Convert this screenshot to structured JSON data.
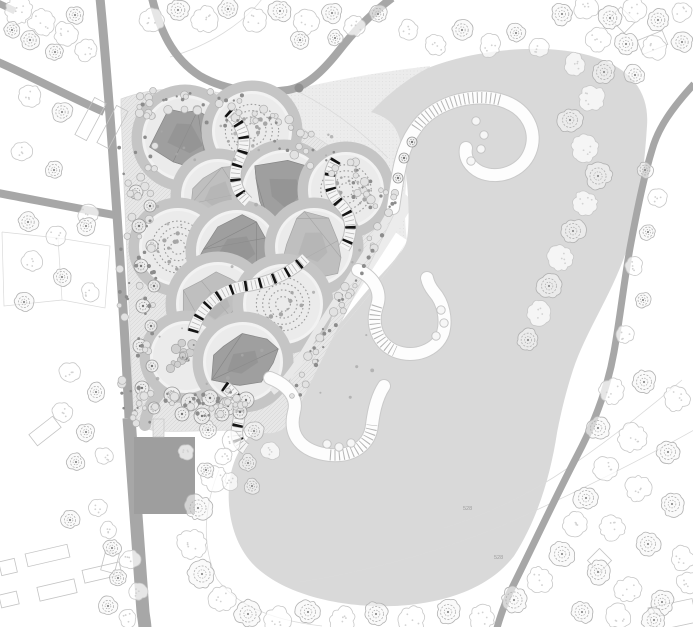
{
  "canvas": {
    "width": 693,
    "height": 627
  },
  "palette": {
    "background": "#ffffff",
    "lake": "#d9d9d9",
    "meadow": "#ececec",
    "meadow_dot": "#dcdcdc",
    "garden_base": "#e7e7e7",
    "garden_hatch": "#d2d2d2",
    "path_band": "#c5c5c5",
    "room_disc": "#ebebeb",
    "room_white_ring": "#f2f2f2",
    "canopy_dark": "#9b9b9b",
    "canopy_dark_line": "#868686",
    "canopy_light": "#bdbdbd",
    "canopy_light_line": "#a5a5a5",
    "ring_planting": "#9a9a9a",
    "shrub": "#a6a6a6",
    "road": "#a7a7a7",
    "building_solid": "#9e9e9e",
    "pier_fill": "#fdfdfd",
    "pier_edge": "#c9c9c9",
    "pier_tick": "#b5b5b5",
    "stair_tread": "#141414",
    "stair_fill": "#f5f5f5",
    "stair_edge": "#bdbdbd",
    "tree_fluffy_stroke": "#c8c8c8",
    "tree_rosette_stroke": "#b2b2b2",
    "tree_small_stroke": "#979797",
    "contour": "#dadada",
    "label_color": "#9e9e9e",
    "junction": "#8f8f8f"
  },
  "labels": [
    {
      "text": "528",
      "x": 463,
      "y": 510
    },
    {
      "text": "528",
      "x": 494,
      "y": 559
    }
  ],
  "map": {
    "lake": {
      "path": "M 428,68 C 468,52 528,44 574,52 C 624,61 650,86 647,126 C 644,172 639,212 626,252 C 611,296 586,331 573,370 C 564,398 560,418 557,433 C 551,472 539,517 514,556 C 487,591 439,604 394,606 C 344,608 288,596 257,568 C 234,547 227,514 229,487 C 231,461 242,441 259,427 C 272,416 281,403 289,392 C 311,362 341,330 369,295 C 391,267 402,252 407,239 C 403,250 392,264 378,278 L 378,278 C 402,252 405,248 407,239 C 411,215 407,165 400,140 C 396,126 390,118 371,112 C 386,96 405,80 428,68 Z"
    },
    "lake_west_fix": {
      "path": "M 407,239 C 403,250 392,264 378,278 C 350,310 320,348 289,392 C 311,362 341,330 369,295 C 391,267 402,252 407,239 Z"
    },
    "meadow": {
      "path": "M 260,98 C 320,82 378,72 430,66 C 428,96 416,130 408,170 C 404,195 404,220 407,240 C 390,230 370,210 350,185 C 325,155 295,125 260,98 Z",
      "strip": "M 398,205 C 370,250 340,295 312,340 C 298,364 288,384 280,400"
    },
    "garden": {
      "zone": "M 121,99 C 158,85 200,86 240,98 C 282,112 330,146 390,186 C 398,192 400,202 395,212 C 362,282 325,352 297,412 C 290,428 278,436 262,433 C 230,427 192,433 158,431 C 143,430 134,422 133,407 C 129,306 125,200 121,112 Z",
      "rooms": [
        {
          "cx": 185,
          "cy": 138,
          "r": 40,
          "type": "canopy"
        },
        {
          "cx": 252,
          "cy": 131,
          "r": 37,
          "type": "rings"
        },
        {
          "cx": 218,
          "cy": 196,
          "r": 34,
          "type": "facet"
        },
        {
          "cx": 284,
          "cy": 192,
          "r": 39,
          "type": "canopy"
        },
        {
          "cx": 346,
          "cy": 190,
          "r": 35,
          "type": "rings"
        },
        {
          "cx": 178,
          "cy": 247,
          "r": 36,
          "type": "rings"
        },
        {
          "cx": 237,
          "cy": 251,
          "r": 38,
          "type": "canopy"
        },
        {
          "cx": 314,
          "cy": 247,
          "r": 36,
          "type": "facet"
        },
        {
          "cx": 218,
          "cy": 304,
          "r": 39,
          "type": "facet"
        },
        {
          "cx": 283,
          "cy": 304,
          "r": 37,
          "type": "rings"
        },
        {
          "cx": 186,
          "cy": 357,
          "r": 33,
          "type": "shrubs"
        },
        {
          "cx": 243,
          "cy": 362,
          "r": 37,
          "type": "canopy"
        }
      ],
      "connector": "M 158,395 C 150,405 146,415 145,425",
      "stairs": [
        "M 228,112 C 244,126 248,142 240,158 C 232,174 234,190 248,202",
        "M 336,160 C 326,176 328,192 340,204 C 352,216 354,232 344,248",
        "M 193,332 C 200,306 220,290 246,286 C 272,282 292,272 306,258",
        "M 224,386 C 236,394 242,406 238,424 C 235,436 238,444 246,449"
      ],
      "scatter": [
        {
          "x": 119,
          "y": 108,
          "w": 38,
          "h": 318,
          "shear": 0,
          "count": 70,
          "seed": 7
        },
        {
          "x": 138,
          "y": 86,
          "w": 120,
          "h": 36,
          "shear": 0.08,
          "count": 40,
          "seed": 11
        },
        {
          "x": 255,
          "y": 96,
          "w": 140,
          "h": 40,
          "shear": 0.62,
          "count": 48,
          "seed": 13
        },
        {
          "x": 286,
          "y": 398,
          "w": 112,
          "h": 26,
          "shear": -1.95,
          "count": 44,
          "seed": 17
        },
        {
          "x": 165,
          "y": 390,
          "w": 85,
          "h": 26,
          "shear": 0,
          "count": 34,
          "seed": 19
        },
        {
          "x": 152,
          "y": 112,
          "w": 225,
          "h": 286,
          "shear": 0,
          "count": 36,
          "seed": 23,
          "tiny": true
        }
      ]
    },
    "roads": [
      {
        "path": "M 100,-2 C 106,60 112,140 117,215 C 122,290 126,350 129,418",
        "width": 9
      },
      {
        "path": "M 129,418 C 133,470 138,540 143,612 C 144,620 145,624 145,629",
        "width": 13
      },
      {
        "path": "M -2,62 C 30,76 68,96 104,112",
        "width": 8
      },
      {
        "path": "M -2,193 C 35,200 75,208 114,215",
        "width": 8
      },
      {
        "path": "M 152,-2 C 160,30 172,58 200,76 C 228,92 262,94 288,90 C 306,87 322,72 338,52 C 352,34 368,16 392,-2",
        "width": 8
      },
      {
        "path": "M 694,84 C 672,108 658,128 652,150 C 644,176 637,210 630,248 C 624,282 620,318 614,352 C 608,386 596,420 577,456 C 556,496 532,548 509,594 C 504,606 500,617 497,628",
        "width": 7
      },
      {
        "path": "M -2,3 L 15,11",
        "width": 7
      }
    ],
    "junction": {
      "x": 299,
      "y": 88,
      "r": 4.5
    },
    "piers": [
      {
        "path": "M 393,208 C 398,175 400,150 416,128 C 432,104 470,92 500,100 C 528,108 538,132 530,152 C 522,172 498,180 480,172 C 470,167 464,158 466,148",
        "ticks": "M 416,128 C 432,104 470,92 500,100",
        "circles": [
          [
            476,
            121
          ],
          [
            484,
            135
          ],
          [
            481,
            149
          ],
          [
            471,
            161
          ]
        ]
      },
      {
        "path": "M 358,270 C 374,277 382,292 377,306 C 371,324 377,343 395,351 C 415,359 437,350 443,333 C 447,319 443,302 434,292 C 430,287 428,283 427,278",
        "ticks": "M 377,306 C 371,324 377,343 395,351",
        "circles": [
          [
            441,
            310
          ],
          [
            444,
            323
          ],
          [
            436,
            336
          ]
        ]
      },
      {
        "path": "M 270,378 C 288,385 298,398 294,412 C 288,436 302,452 330,455 C 354,457 370,444 372,425 C 374,408 378,395 384,386",
        "ticks": "M 330,455 C 354,457 370,444 372,425",
        "circles": [
          [
            327,
            444
          ],
          [
            339,
            447
          ],
          [
            351,
            443
          ]
        ]
      }
    ],
    "shore_path": "M 396,203 C 370,248 342,292 314,336 C 300,360 288,380 272,392",
    "buildings": {
      "solid": [
        {
          "x": 134,
          "y": 437,
          "w": 61,
          "h": 77
        }
      ],
      "hatch_pad": {
        "x": 153,
        "y": 419,
        "w": 11,
        "h": 18
      },
      "outline": [
        {
          "x": 84,
          "y": 98,
          "w": 13,
          "h": 42,
          "a": 28
        },
        {
          "x": 106,
          "y": 106,
          "w": 13,
          "h": 42,
          "a": 28
        },
        {
          "x": 30,
          "y": 424,
          "w": 30,
          "h": 14,
          "a": -38
        },
        {
          "x": 26,
          "y": 549,
          "w": 43,
          "h": 13,
          "a": -13
        },
        {
          "x": 83,
          "y": 566,
          "w": 38,
          "h": 13,
          "a": -13
        },
        {
          "x": 38,
          "y": 583,
          "w": 38,
          "h": 14,
          "a": -13
        },
        {
          "x": 0,
          "y": 560,
          "w": 16,
          "h": 14,
          "a": -13
        },
        {
          "x": 0,
          "y": 593,
          "w": 18,
          "h": 13,
          "a": -13
        },
        {
          "x": 100,
          "y": 555,
          "w": 20,
          "h": 14,
          "a": -75
        },
        {
          "x": 612,
          "y": 12,
          "w": 21,
          "h": 16,
          "a": 45
        },
        {
          "x": 639,
          "y": 35,
          "w": 27,
          "h": 15,
          "a": -22
        },
        {
          "x": 591,
          "y": 552,
          "w": 17,
          "h": 17,
          "a": 45
        },
        {
          "x": 650,
          "y": 603,
          "w": 45,
          "h": 24,
          "a": -12
        }
      ],
      "plots": [
        [
          [
            2,
            232
          ],
          [
            58,
            238
          ],
          [
            62,
            300
          ],
          [
            4,
            306
          ],
          [
            2,
            232
          ]
        ],
        [
          [
            58,
            238
          ],
          [
            110,
            246
          ],
          [
            105,
            308
          ],
          [
            62,
            300
          ]
        ]
      ]
    },
    "contours": [
      "M 694,430 C 630,466 566,497 506,524 C 446,549 376,570 300,582",
      "M 444,528 C 488,514 530,494 568,468 C 606,442 645,412 682,380",
      "M 262,-1 C 243,24 208,46 170,57",
      "M 219,470 C 204,506 201,546 217,579 C 238,607 276,621 322,626",
      "M 299,92 C 330,108 360,130 388,158"
    ],
    "trees": [
      [
        18,
        10,
        14,
        0
      ],
      [
        42,
        22,
        13,
        0
      ],
      [
        66,
        34,
        12,
        0
      ],
      [
        86,
        50,
        11,
        0
      ],
      [
        30,
        40,
        10,
        1
      ],
      [
        55,
        52,
        9,
        1
      ],
      [
        12,
        30,
        8,
        1
      ],
      [
        75,
        15,
        9,
        1
      ],
      [
        152,
        20,
        12,
        0
      ],
      [
        178,
        10,
        11,
        1
      ],
      [
        204,
        20,
        13,
        0
      ],
      [
        228,
        9,
        10,
        1
      ],
      [
        254,
        20,
        12,
        0
      ],
      [
        280,
        11,
        11,
        1
      ],
      [
        306,
        22,
        12,
        0
      ],
      [
        332,
        13,
        10,
        1
      ],
      [
        355,
        26,
        11,
        0
      ],
      [
        378,
        14,
        9,
        1
      ],
      [
        300,
        40,
        9,
        1
      ],
      [
        335,
        38,
        8,
        1
      ],
      [
        408,
        30,
        10,
        0
      ],
      [
        436,
        45,
        11,
        0
      ],
      [
        462,
        30,
        10,
        1
      ],
      [
        490,
        46,
        11,
        0
      ],
      [
        516,
        33,
        9,
        1
      ],
      [
        540,
        48,
        10,
        0
      ],
      [
        562,
        14,
        11,
        1
      ],
      [
        586,
        8,
        12,
        0
      ],
      [
        610,
        18,
        11,
        1
      ],
      [
        634,
        9,
        12,
        0
      ],
      [
        658,
        20,
        11,
        1
      ],
      [
        682,
        12,
        10,
        0
      ],
      [
        598,
        40,
        12,
        0
      ],
      [
        626,
        44,
        11,
        1
      ],
      [
        654,
        48,
        12,
        0
      ],
      [
        682,
        42,
        10,
        1
      ],
      [
        575,
        65,
        11,
        0
      ],
      [
        604,
        72,
        12,
        1
      ],
      [
        592,
        98,
        13,
        0
      ],
      [
        570,
        120,
        12,
        1
      ],
      [
        635,
        75,
        10,
        1
      ],
      [
        585,
        148,
        13,
        0
      ],
      [
        598,
        176,
        13,
        1
      ],
      [
        586,
        204,
        13,
        0
      ],
      [
        573,
        231,
        12,
        1
      ],
      [
        561,
        258,
        13,
        0
      ],
      [
        549,
        286,
        12,
        1
      ],
      [
        538,
        313,
        12,
        0
      ],
      [
        528,
        340,
        11,
        1
      ],
      [
        645,
        170,
        8,
        1
      ],
      [
        658,
        198,
        9,
        0
      ],
      [
        648,
        232,
        8,
        1
      ],
      [
        634,
        266,
        9,
        0
      ],
      [
        643,
        300,
        8,
        1
      ],
      [
        625,
        335,
        9,
        0
      ],
      [
        612,
        392,
        13,
        0
      ],
      [
        644,
        382,
        12,
        1
      ],
      [
        676,
        398,
        13,
        0
      ],
      [
        598,
        428,
        12,
        1
      ],
      [
        632,
        438,
        14,
        0
      ],
      [
        668,
        452,
        12,
        1
      ],
      [
        606,
        468,
        12,
        0
      ],
      [
        586,
        498,
        12,
        1
      ],
      [
        638,
        488,
        13,
        0
      ],
      [
        672,
        504,
        12,
        1
      ],
      [
        612,
        528,
        13,
        0
      ],
      [
        648,
        544,
        12,
        1
      ],
      [
        682,
        558,
        12,
        0
      ],
      [
        598,
        572,
        12,
        1
      ],
      [
        628,
        590,
        13,
        0
      ],
      [
        662,
        602,
        12,
        1
      ],
      [
        688,
        582,
        11,
        0
      ],
      [
        582,
        612,
        11,
        1
      ],
      [
        618,
        616,
        12,
        0
      ],
      [
        654,
        620,
        11,
        1
      ],
      [
        214,
        478,
        13,
        0
      ],
      [
        198,
        508,
        13,
        1
      ],
      [
        192,
        544,
        14,
        0
      ],
      [
        202,
        574,
        13,
        1
      ],
      [
        222,
        598,
        13,
        0
      ],
      [
        248,
        614,
        13,
        1
      ],
      [
        278,
        620,
        13,
        0
      ],
      [
        308,
        612,
        12,
        1
      ],
      [
        342,
        620,
        13,
        0
      ],
      [
        376,
        614,
        12,
        1
      ],
      [
        412,
        620,
        13,
        0
      ],
      [
        448,
        612,
        12,
        1
      ],
      [
        482,
        618,
        13,
        0
      ],
      [
        514,
        600,
        13,
        1
      ],
      [
        540,
        580,
        13,
        0
      ],
      [
        562,
        554,
        12,
        1
      ],
      [
        576,
        524,
        12,
        0
      ],
      [
        208,
        430,
        9,
        1
      ],
      [
        232,
        441,
        10,
        0
      ],
      [
        254,
        431,
        9,
        1
      ],
      [
        224,
        456,
        9,
        0
      ],
      [
        248,
        463,
        9,
        1
      ],
      [
        270,
        451,
        9,
        0
      ],
      [
        206,
        470,
        8,
        1
      ],
      [
        230,
        481,
        9,
        0
      ],
      [
        252,
        486,
        8,
        1
      ],
      [
        186,
        452,
        8,
        0
      ],
      [
        30,
        96,
        11,
        0
      ],
      [
        62,
        112,
        10,
        1
      ],
      [
        22,
        152,
        10,
        0
      ],
      [
        54,
        170,
        9,
        1
      ],
      [
        88,
        214,
        10,
        0
      ],
      [
        28,
        222,
        10,
        1
      ],
      [
        56,
        236,
        10,
        0
      ],
      [
        86,
        226,
        9,
        1
      ],
      [
        32,
        262,
        10,
        0
      ],
      [
        62,
        277,
        9,
        1
      ],
      [
        90,
        292,
        9,
        0
      ],
      [
        24,
        302,
        9,
        1
      ],
      [
        70,
        372,
        10,
        0
      ],
      [
        96,
        392,
        9,
        1
      ],
      [
        62,
        412,
        10,
        0
      ],
      [
        86,
        432,
        9,
        1
      ],
      [
        104,
        456,
        9,
        0
      ],
      [
        76,
        462,
        9,
        1
      ],
      [
        98,
        508,
        9,
        0
      ],
      [
        70,
        520,
        9,
        1
      ],
      [
        108,
        530,
        8,
        0
      ],
      [
        136,
        192,
        7,
        2
      ],
      [
        150,
        206,
        6,
        2
      ],
      [
        139,
        226,
        7,
        2
      ],
      [
        152,
        246,
        6,
        2
      ],
      [
        141,
        266,
        7,
        2
      ],
      [
        154,
        286,
        6,
        2
      ],
      [
        143,
        306,
        7,
        2
      ],
      [
        151,
        326,
        6,
        2
      ],
      [
        140,
        346,
        7,
        2
      ],
      [
        152,
        366,
        6,
        2
      ],
      [
        142,
        388,
        7,
        2
      ],
      [
        154,
        408,
        6,
        2
      ],
      [
        404,
        158,
        5,
        2
      ],
      [
        398,
        178,
        5,
        2
      ],
      [
        412,
        142,
        5,
        2
      ],
      [
        172,
        395,
        8,
        2
      ],
      [
        190,
        402,
        9,
        2
      ],
      [
        210,
        398,
        8,
        2
      ],
      [
        228,
        406,
        9,
        2
      ],
      [
        246,
        400,
        8,
        2
      ],
      [
        182,
        414,
        7,
        2
      ],
      [
        202,
        416,
        8,
        2
      ],
      [
        222,
        414,
        7,
        2
      ],
      [
        240,
        412,
        7,
        2
      ],
      [
        112,
        548,
        9,
        1
      ],
      [
        130,
        560,
        10,
        0
      ],
      [
        118,
        578,
        9,
        1
      ],
      [
        138,
        592,
        9,
        0
      ],
      [
        108,
        606,
        9,
        1
      ],
      [
        128,
        618,
        9,
        0
      ]
    ]
  }
}
